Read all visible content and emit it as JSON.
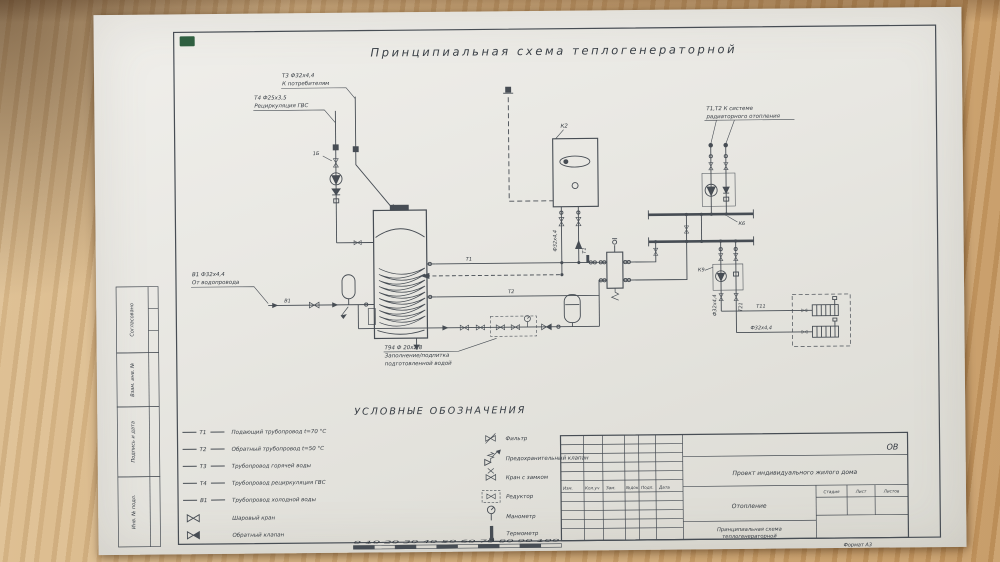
{
  "colors": {
    "paper": "#e9e8e3",
    "ink": "#474d54",
    "text": "#343a41",
    "wood": "#cfa876",
    "sticker_green": "#2f5f40"
  },
  "title": "Принципиальная схема теплогенераторной",
  "schematic": {
    "t3_label1": "Т3 Ф32х4,4",
    "t3_label2": "К потребителям",
    "t4_label1": "Т4 Ф25х3,5",
    "t4_label2": "Рециркуляция ГВС",
    "b1_label1": "В1 Ф32х4,4",
    "b1_label2": "От водопровода",
    "b1_tag": "В1",
    "t94_label1": "Т94 Ф 20х2,8",
    "t94_label2": "Заполнение/подпитка",
    "t94_label3": "подготовленной водой",
    "k2": "К2",
    "k6": "К6",
    "k9": "К9",
    "pos_1b": "1Б",
    "rad_label1": "Т1,Т2  К системе",
    "rad_label2": "радиаторного отопления",
    "t1": "Т1",
    "t2": "Т2",
    "t11": "Т11",
    "t21": "Т21",
    "dn32": "Ф32х4,4"
  },
  "legend": {
    "heading": "УСЛОВНЫЕ ОБОЗНАЧЕНИЯ",
    "pipes": [
      {
        "tag": "Т1",
        "desc": "Подающий трубопровод t=70 °С"
      },
      {
        "tag": "Т2",
        "desc": "Обратный трубопровод t=50 °С"
      },
      {
        "tag": "Т3",
        "desc": "Трубопровод горячей воды"
      },
      {
        "tag": "Т4",
        "desc": "Трубопровод рециркуляция ГВС"
      },
      {
        "tag": "В1",
        "desc": "Трубопровод холодной воды"
      }
    ],
    "valves": [
      "Шаровый кран",
      "Обратный клапан"
    ],
    "symbols": [
      "Фильтр",
      "Предохранительный клапан",
      "Кран с замком",
      "Редуктор",
      "Манометр",
      "Термометр"
    ]
  },
  "titleblock": {
    "code": "ОВ",
    "project": "Проект индивидуального жилого дома",
    "section": "Отопление",
    "drawing_line1": "Принципиальная схема",
    "drawing_line2": "теплогенераторной",
    "rev_cols": [
      "Изм.",
      "Кол.уч",
      "Зам.",
      "№док.",
      "Подп.",
      "Дата"
    ],
    "stage_cols": [
      "Стадия",
      "Лист",
      "Листов"
    ]
  },
  "margin_stamps": {
    "approved": "Согласовано",
    "replace_inv": "Взам. инв. №",
    "sign_date": "Подпись и дата",
    "inv_original": "Инв. № подл."
  },
  "ruler_numbers": "0 10 20 30 40 50 60 70 80 90 100",
  "format_note": "Формат А3"
}
